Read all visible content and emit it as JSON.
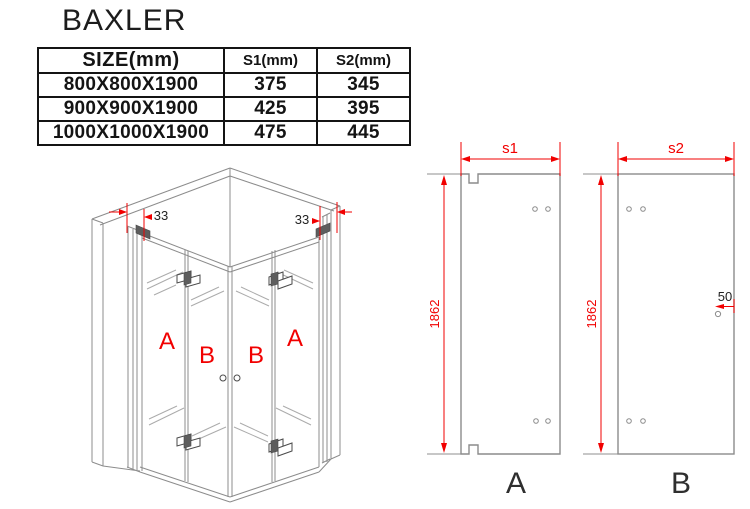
{
  "title": "BAXLER",
  "table": {
    "headers": [
      "SIZE(mm)",
      "S1(mm)",
      "S2(mm)"
    ],
    "rows": [
      {
        "size": "800X800X1900",
        "s1": "375",
        "s2": "345"
      },
      {
        "size": "900X900X1900",
        "s1": "425",
        "s2": "395"
      },
      {
        "size": "1000X1000X1900",
        "s1": "475",
        "s2": "445"
      }
    ]
  },
  "iso": {
    "labels": [
      "A",
      "B",
      "B",
      "A"
    ],
    "wall_profile_dim_left": "33",
    "wall_profile_dim_right": "33"
  },
  "panel_a": {
    "label": "A",
    "width_dim": "s1",
    "height_dim": "1862"
  },
  "panel_b": {
    "label": "B",
    "width_dim": "s2",
    "height_dim": "1862",
    "hole_offset_dim": "50"
  },
  "colors": {
    "dimension_red": "#f10000",
    "drawing_gray": "#8c8c8c",
    "text_black": "#1a1a1a"
  }
}
